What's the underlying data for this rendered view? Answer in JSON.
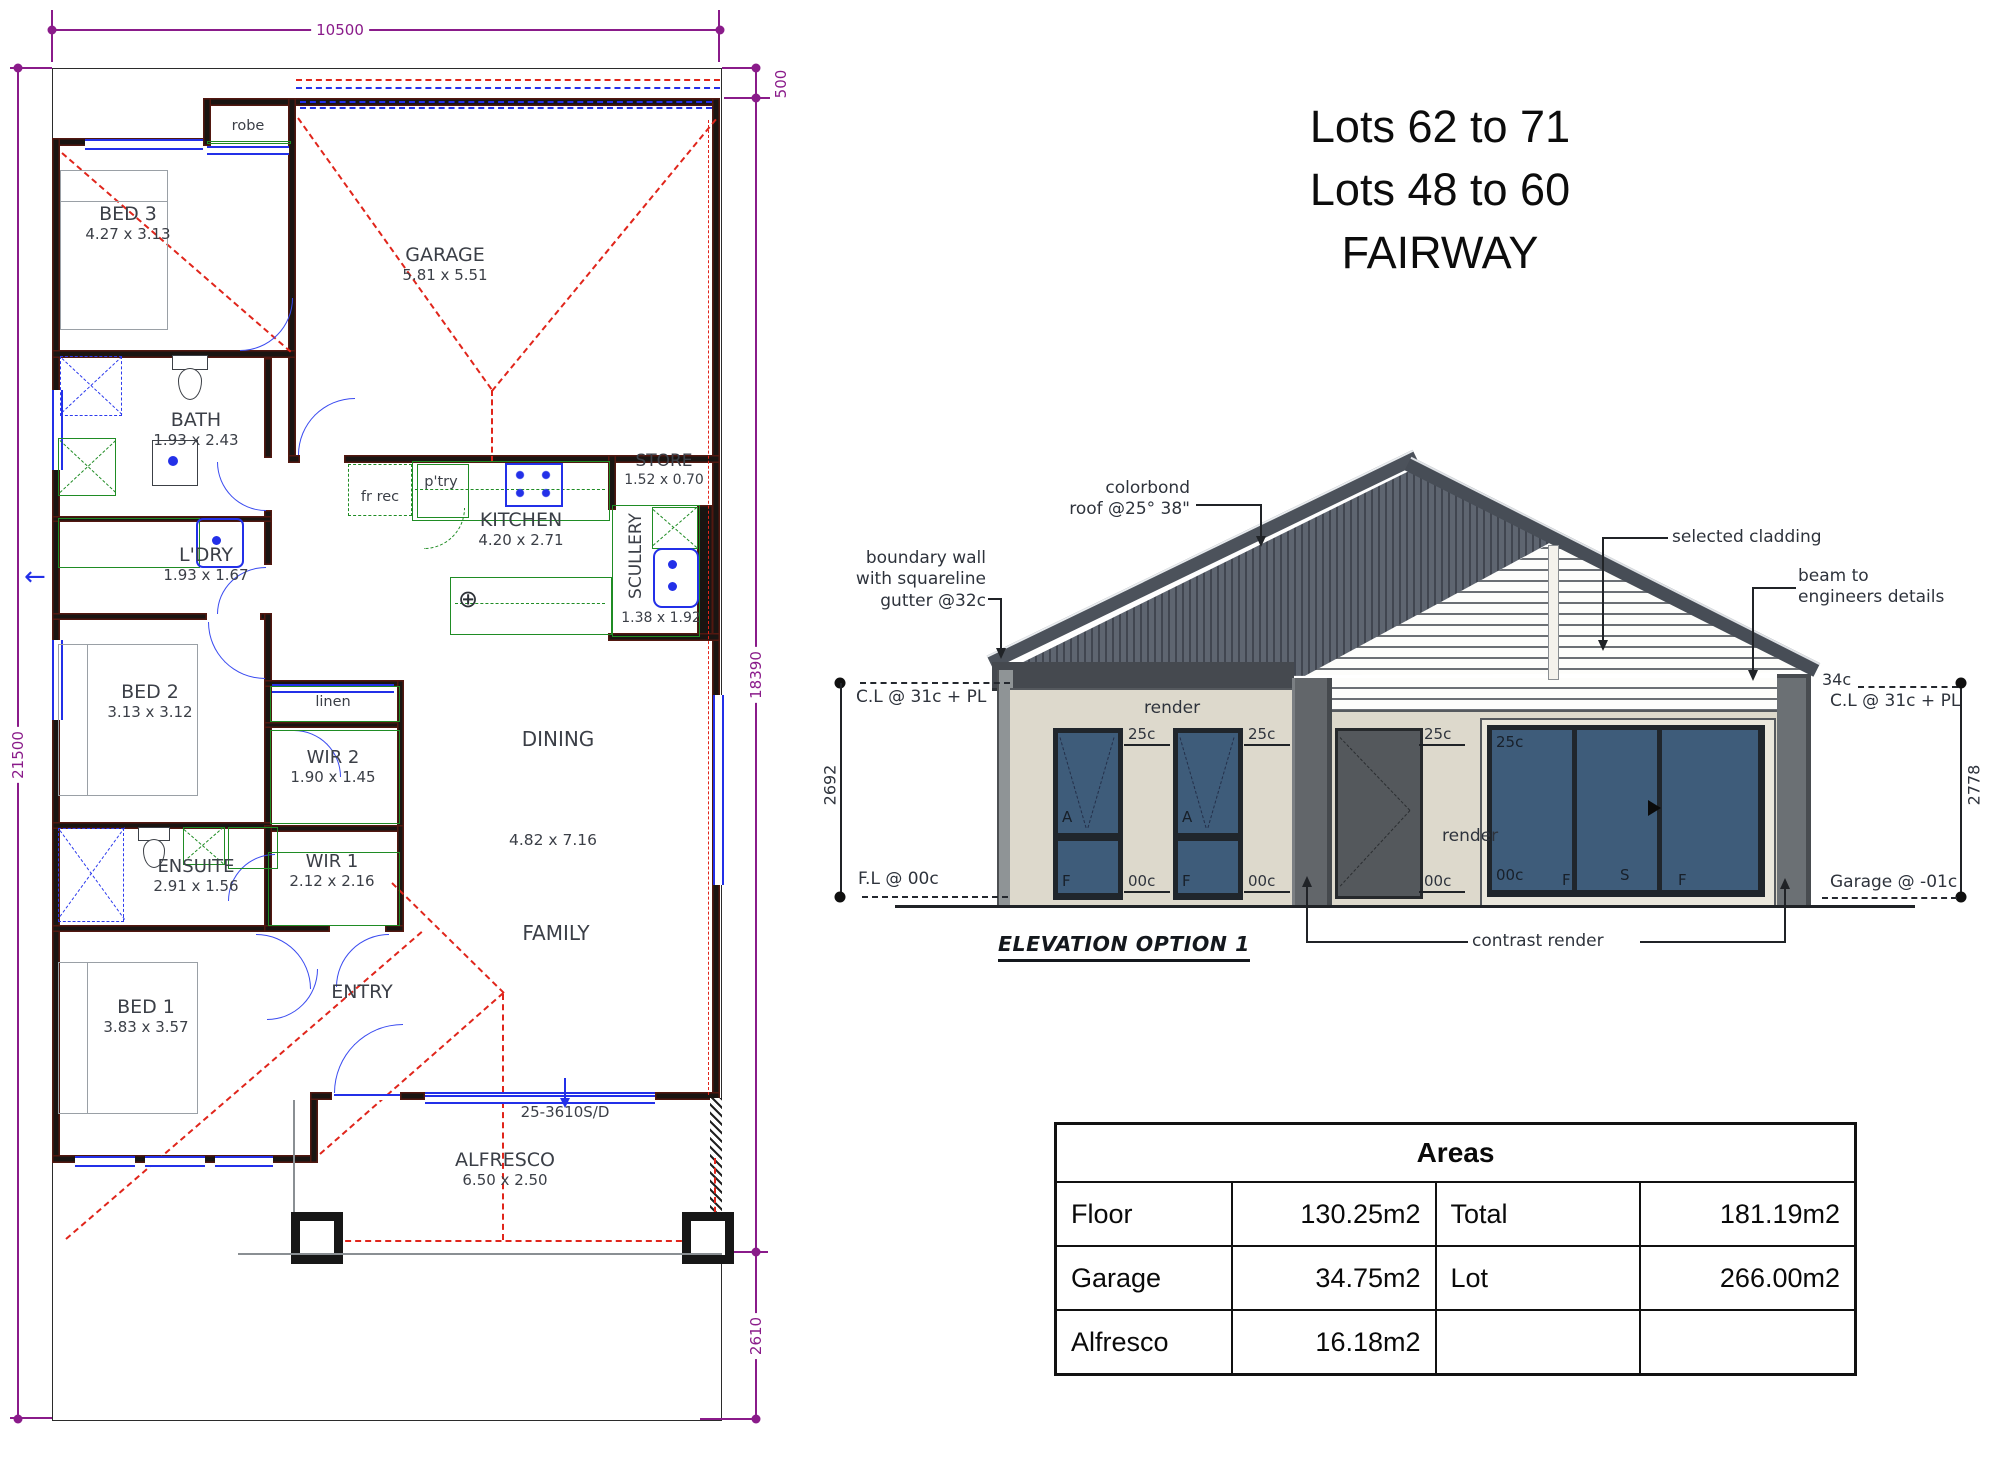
{
  "title_block": {
    "lines": [
      "Lots 62 to 71",
      "Lots 48 to 60",
      "FAIRWAY"
    ]
  },
  "floor_plan": {
    "dims": {
      "top": "10500",
      "left": "21500",
      "offset_top": "500",
      "right_main": "18390",
      "right_bottom": "2610"
    },
    "rooms": {
      "bed3": {
        "label": "BED 3",
        "size": "4.27 x 3.13"
      },
      "robe": {
        "label": "robe"
      },
      "garage": {
        "label": "GARAGE",
        "size": "5.81 x 5.51"
      },
      "bath": {
        "label": "BATH",
        "size": "1.93 x 2.43"
      },
      "ldry": {
        "label": "L'DRY",
        "size": "1.93 x 1.67"
      },
      "fr_rec": {
        "label": "fr rec"
      },
      "ptry": {
        "label": "p'try"
      },
      "kitchen": {
        "label": "KITCHEN",
        "size": "4.20 x 2.71"
      },
      "store": {
        "label": "STORE",
        "size": "1.52 x 0.70"
      },
      "scullery": {
        "label": "SCULLERY",
        "size": "1.38 x 1.92"
      },
      "bed2": {
        "label": "BED 2",
        "size": "3.13 x 3.12"
      },
      "linen": {
        "label": "linen"
      },
      "wir2": {
        "label": "WIR 2",
        "size": "1.90 x 1.45"
      },
      "dining": {
        "label": "DINING",
        "size": "4.82 x 7.16"
      },
      "ensuite": {
        "label": "ENSUITE",
        "size": "2.91 x 1.56"
      },
      "wir1": {
        "label": "WIR 1",
        "size": "2.12 x 2.16"
      },
      "family": {
        "label": "FAMILY"
      },
      "bed1": {
        "label": "BED 1",
        "size": "3.83 x 3.57"
      },
      "entry": {
        "label": "ENTRY"
      },
      "alfresco": {
        "label": "ALFRESCO",
        "size": "6.50 x 2.50"
      }
    },
    "annotations": {
      "sliding_door": "25-3610S/D"
    }
  },
  "elevation": {
    "title": "ELEVATION OPTION 1",
    "callouts": {
      "colorbond": [
        "colorbond",
        "roof @25° 38\""
      ],
      "boundary": [
        "boundary wall",
        "with squareline",
        "gutter @32c"
      ],
      "cladding": "selected cladding",
      "beam": [
        "beam to",
        "engineers details"
      ],
      "contrast": "contrast render",
      "render": "render"
    },
    "levels": {
      "cl": "C.L @ 31c + PL",
      "fl": "F.L @ 00c",
      "garage": "Garage @ -01c",
      "c34": "34c",
      "head": "25c",
      "sill": "00c"
    },
    "dims": {
      "left": "2692",
      "right": "2778"
    },
    "window_tags": {
      "awning": "A",
      "fixed": "F",
      "sliding": "S"
    }
  },
  "areas_table": {
    "title": "Areas",
    "rows": [
      [
        "Floor",
        "130.25m2",
        "Total",
        "181.19m2"
      ],
      [
        "Garage",
        "34.75m2",
        "Lot",
        "266.00m2"
      ],
      [
        "Alfresco",
        "16.18m2",
        "",
        ""
      ]
    ]
  }
}
